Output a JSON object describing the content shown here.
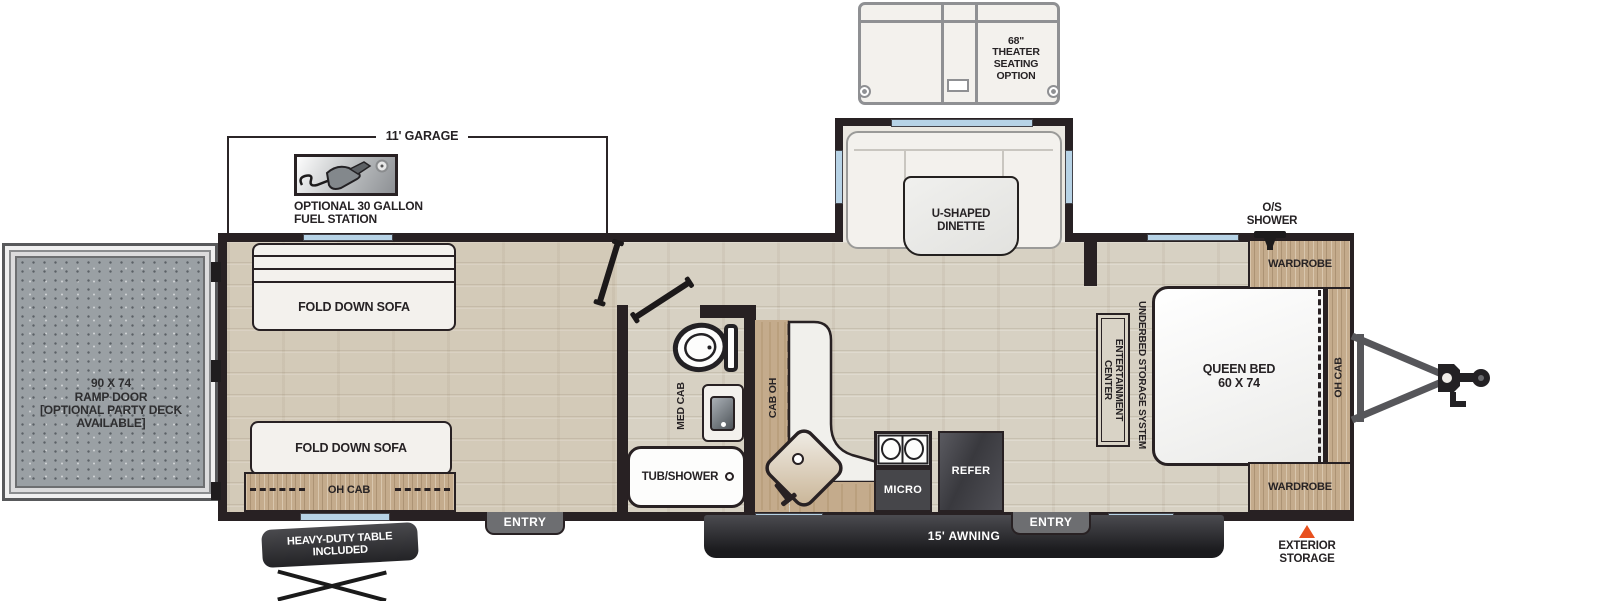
{
  "colors": {
    "wall": "#282123",
    "floor": "#d7d1c3",
    "cabinet_wood": "#c4ab8c",
    "window_glass": "#b7d3e6",
    "appliance_dark": "#46464a",
    "ramp_gray": "#9aa0a4",
    "accent_orange": "#e8501e",
    "badge_gray": "#6d6e71"
  },
  "icons": {
    "fuel_pump": "fuel-pump-icon",
    "shower_head": "shower-head-icon",
    "toilet": "toilet-fixture-icon",
    "sink": "sink-fixture-icon",
    "cooktop": "cooktop-burners-icon",
    "hitch": "hitch-tongue-icon",
    "storage_marker": "exterior-storage-triangle-icon"
  },
  "labels": {
    "theater_seating": "68\"\nTHEATER\nSEATING\nOPTION",
    "garage_dim": "11' GARAGE",
    "fuel_station": "OPTIONAL 30 GALLON\nFUEL STATION",
    "ramp_door": "90 X 74\nRAMP DOOR\n[OPTIONAL PARTY DECK\nAVAILABLE]",
    "sofa_top": "FOLD DOWN SOFA",
    "sofa_bottom": "FOLD DOWN SOFA",
    "garage_oh_cab": "OH CAB",
    "entry_left": "ENTRY",
    "entry_right": "ENTRY",
    "table_included": "HEAVY-DUTY TABLE\nINCLUDED",
    "med_cab": "MED CAB",
    "tub_shower": "TUB/SHOWER",
    "kitchen_cab_oh": "CAB OH",
    "micro": "MICRO",
    "refer": "REFER",
    "dinette": "U-SHAPED\nDINETTE",
    "awning": "15' AWNING",
    "queen_bed": "QUEEN BED\n60 X 74",
    "wardrobe_top": "WARDROBE",
    "wardrobe_bottom": "WARDROBE",
    "bed_oh_cab": "OH CAB",
    "underbed_storage": "UNDERBED STORAGE SYSTEM",
    "entertainment_center": "ENTERTAINMENT\nCENTER",
    "os_shower": "O/S\nSHOWER",
    "exterior_storage": "EXTERIOR\nSTORAGE"
  }
}
